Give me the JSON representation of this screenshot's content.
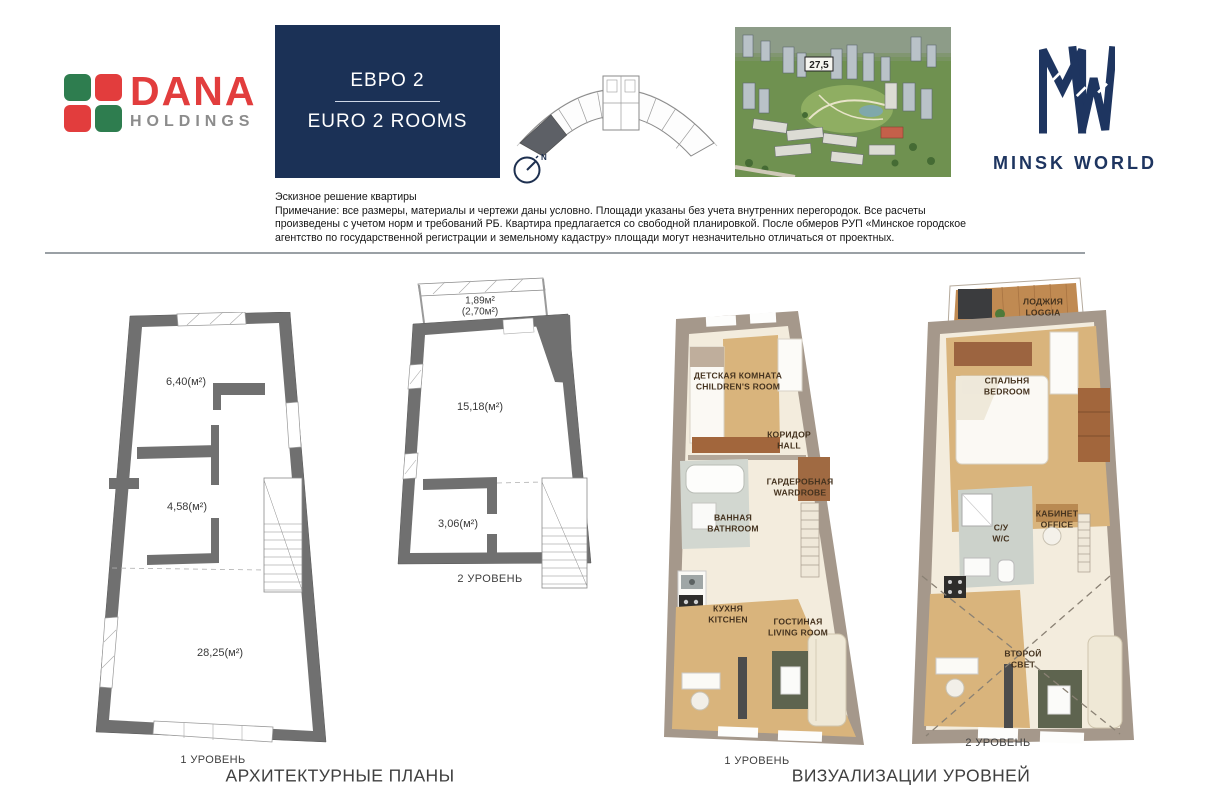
{
  "header": {
    "dana": {
      "name": "DANA",
      "sub": "HOLDINGS"
    },
    "unit_card": {
      "title_ru": "ЕВРО 2",
      "title_en": "EURO 2 ROOMS"
    },
    "site_plan": {
      "north_label": "N"
    },
    "aerial": {
      "building_label": "27,5"
    },
    "minsk_world": {
      "name": "MINSK WORLD"
    }
  },
  "disclaimer": {
    "title": "Эскизное решение квартиры",
    "body": "Примечание: все размеры, материалы и чертежи даны условно. Площади указаны без учета внутренних перегородок. Все расчеты произведены с учетом норм и требований РБ. Квартира предлагается со свободной планировкой. После обмеров РУП «Минское городское агентство по государственной регистрации и земельному кадастру» площади могут незначительно отличаться от проектных."
  },
  "plans": {
    "level1": {
      "label": "1 УРОВЕНЬ",
      "areas": [
        "6,40(м²)",
        "4,58(м²)",
        "28,25(м²)"
      ]
    },
    "level2": {
      "label": "2 УРОВЕНЬ",
      "loggia_small": "1,89м²",
      "loggia_big": "(2,70м²)",
      "areas": [
        "15,18(м²)",
        "3,06(м²)"
      ]
    }
  },
  "viz": {
    "level1": {
      "label": "1 УРОВЕНЬ",
      "rooms": [
        "ДЕТСКАЯ КОМНАТА\nCHILDREN'S ROOM",
        "КОРИДОР\nHALL",
        "ГАРДЕРОБНАЯ\nWARDROBE",
        "ВАННАЯ\nBATHROOM",
        "КУХНЯ\nKITCHEN",
        "ГОСТИНАЯ\nLIVING ROOM"
      ]
    },
    "level2": {
      "label": "2 УРОВЕНЬ",
      "rooms": [
        "ЛОДЖИЯ\nLOGGIA",
        "СПАЛЬНЯ\nBEDROOM",
        "С/У\nW/C",
        "КАБИНЕТ\nOFFICE",
        "ВТОРОЙ\nСВЕТ"
      ]
    }
  },
  "captions": {
    "plans": "АРХИТЕКТУРНЫЕ ПЛАНЫ",
    "viz": "ВИЗУАЛИЗАЦИИ УРОВНЕЙ"
  },
  "colors": {
    "navy": "#1b3156",
    "logo_navy": "#1e3560",
    "dana_red": "#e23d3d",
    "dana_green": "#2e7d4f",
    "wall_gray": "#707070",
    "wall_taupe": "#a5988b",
    "wood": "#d9b47c",
    "floor_cream": "#f3ecdd"
  }
}
